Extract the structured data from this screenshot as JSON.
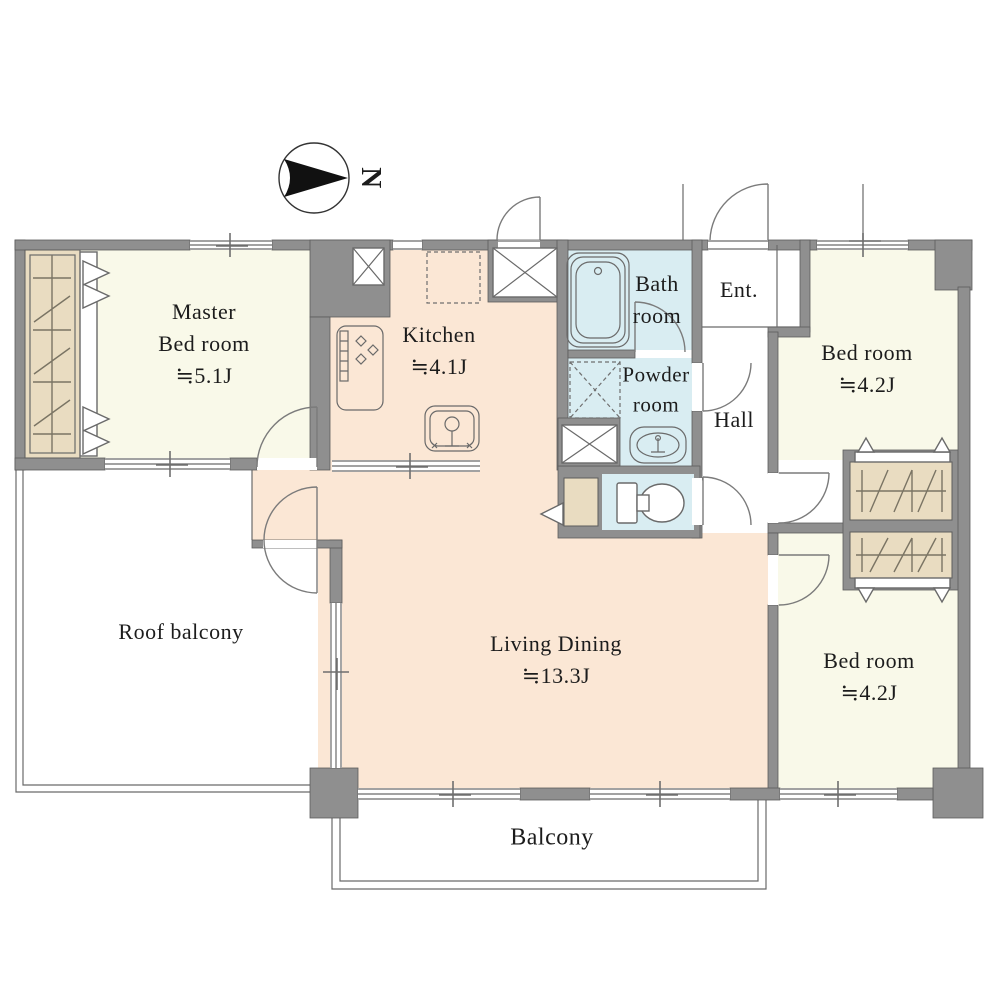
{
  "floor_plan": {
    "compass": {
      "label": "N"
    },
    "rooms": {
      "master_bedroom": {
        "line1": "Master",
        "line2": "Bed room",
        "area": "≒5.1J"
      },
      "kitchen": {
        "name": "Kitchen",
        "area": "≒4.1J"
      },
      "bathroom": {
        "line1": "Bath",
        "line2": "room"
      },
      "powder_room": {
        "line1": "Powder",
        "line2": "room"
      },
      "entrance": {
        "name": "Ent."
      },
      "hall": {
        "name": "Hall"
      },
      "bedroom_north": {
        "name": "Bed room",
        "area": "≒4.2J"
      },
      "bedroom_south": {
        "name": "Bed room",
        "area": "≒4.2J"
      },
      "living_dining": {
        "name": "Living Dining",
        "area": "≒13.3J"
      },
      "roof_balcony": {
        "name": "Roof balcony"
      },
      "balcony": {
        "name": "Balcony"
      }
    },
    "colors": {
      "wall": "#8f8f8f",
      "wall_outline": "#5c5c5c",
      "cream": "#f9f9e9",
      "peach": "#fbe7d5",
      "blue": "#d9edf2",
      "tan": "#e9dcc1",
      "line": "#6a6a6a",
      "text": "#1c1c1c"
    }
  }
}
